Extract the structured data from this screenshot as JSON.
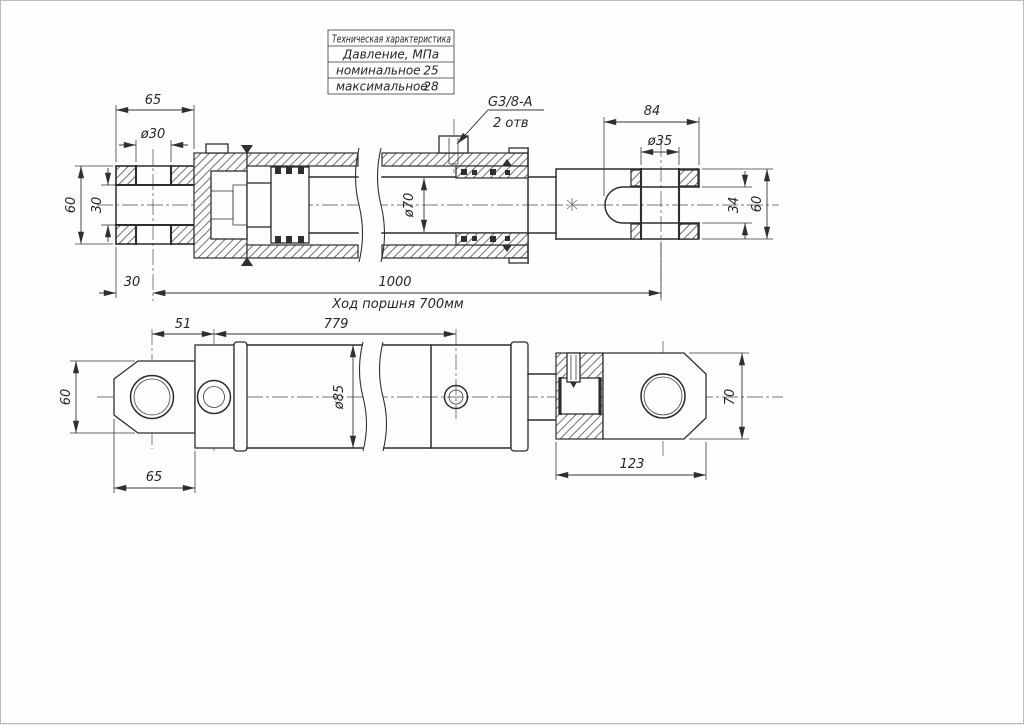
{
  "spec_table": {
    "title": "Техническая характеристика",
    "subheader": "Давление, МПа",
    "rows": [
      {
        "label": "номинальное",
        "value": "25"
      },
      {
        "label": "максимальное",
        "value": "28"
      }
    ]
  },
  "port_callout": {
    "thread": "G3/8-A",
    "holes": "2 отв"
  },
  "top_view": {
    "eye_length": "65",
    "eye_hole_dia": "ø30",
    "eye_height": "60",
    "eye_slot_width": "30",
    "pin_offset": "30",
    "pin_to_pin_length": "1000",
    "stroke_note": "Ход поршня 700мм",
    "rod_dia": "ø70",
    "clevis_depth": "84",
    "clevis_hole_dia": "ø35",
    "clevis_slot_width": "34",
    "clevis_height": "60"
  },
  "bottom_view": {
    "eye_height": "60",
    "port_offset": "51",
    "port_spacing": "779",
    "outer_dia": "ø85",
    "eye_length": "65",
    "rod_end_length": "123",
    "rod_eye_height": "70"
  }
}
